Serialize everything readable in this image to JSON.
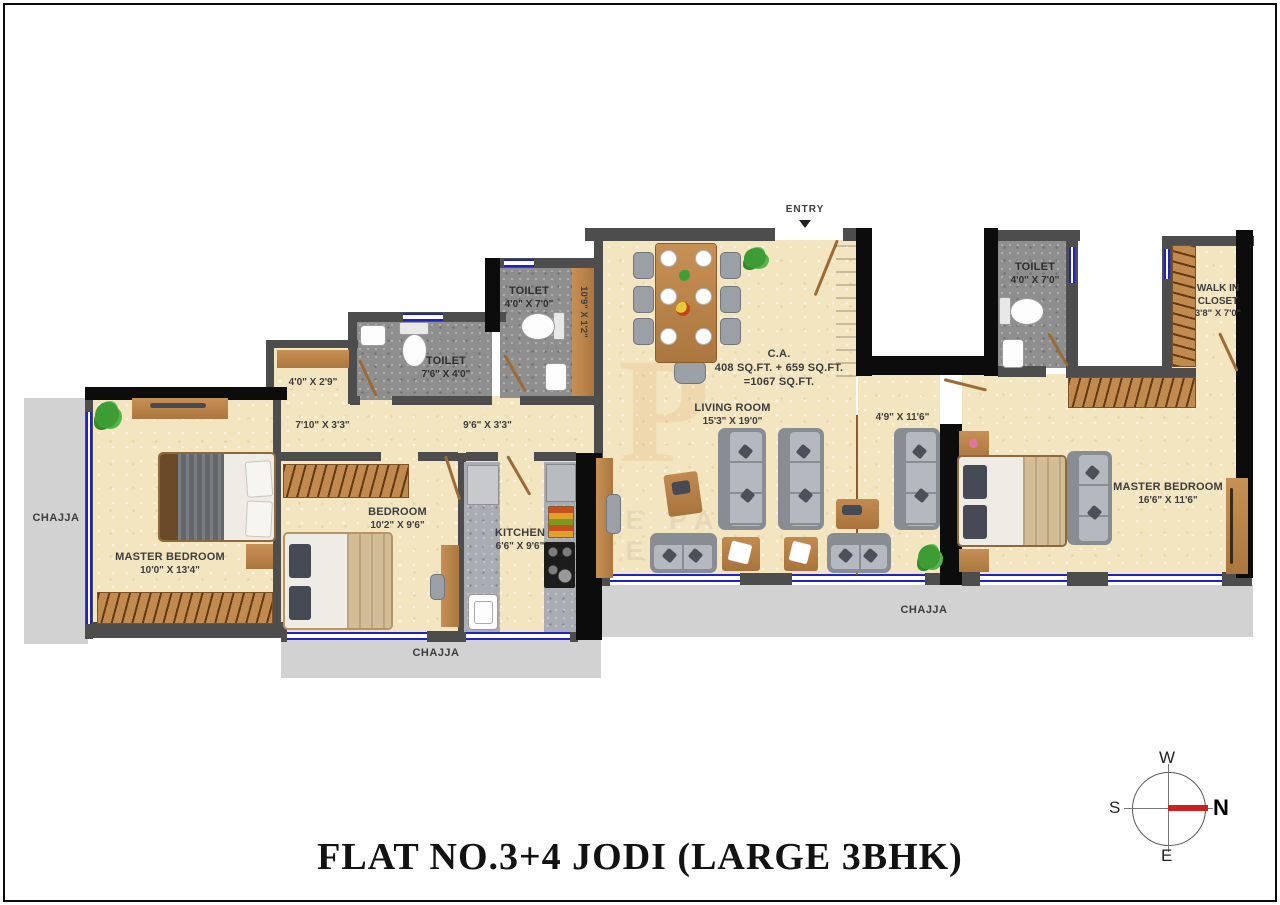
{
  "title": "FLAT NO.3+4 JODI (LARGE 3BHK)",
  "entry_label": "ENTRY",
  "area_note": {
    "l1": "C.A.",
    "l2": "408 SQ.FT. + 659 SQ.FT.",
    "l3": "=1067 SQ.FT."
  },
  "rooms": {
    "living": {
      "name": "LIVING ROOM",
      "dim": "15'3\" X 19'0\""
    },
    "master_left": {
      "name": "MASTER BEDROOM",
      "dim": "10'0\" X 13'4\""
    },
    "master_right": {
      "name": "MASTER BEDROOM",
      "dim": "16'6\" X 11'6\""
    },
    "bedroom": {
      "name": "BEDROOM",
      "dim": "10'2\" X 9'6\""
    },
    "kitchen": {
      "name": "KITCHEN",
      "dim": "6'6\" X 9'6\""
    },
    "toilet_left": {
      "name": "TOILET",
      "dim": "7'6\" X 4'0\""
    },
    "toilet_mid": {
      "name": "TOILET",
      "dim": "4'0\" X 7'0\""
    },
    "toilet_right": {
      "name": "TOILET",
      "dim": "4'0\" X 7'0\""
    },
    "walk_in_closet": {
      "name": "WALK IN CLOSET",
      "dim": "3'8\" X 7'0\""
    }
  },
  "passages": {
    "nook": "4'0\" X 2'9\"",
    "corridor_left": "7'10\" X 3'3\"",
    "corridor_right": "9'6\" X 3'3\"",
    "duct": "10'9\" X 1'2\"",
    "foyer": "4'9\" X 11'6\""
  },
  "chajja": {
    "left": "CHAJJA",
    "bottom": "CHAJJA",
    "right": "CHAJJA"
  },
  "compass": {
    "n": "N",
    "e": "E",
    "s": "S",
    "w": "W"
  },
  "watermark": {
    "letter": "P",
    "row1": "LE PA",
    "row2": "TELIE"
  },
  "colors": {
    "floor": "#f2e5c0",
    "wall": "#4d4d4d",
    "wall_black": "#0c0c0c",
    "wood": "#c08a4f",
    "window_blue": "#2121c8",
    "toilet_floor": "#8e8e8e",
    "chajja": "#d2d2d2",
    "sofa": "#878d93",
    "needle_red": "#cf1f1f"
  }
}
